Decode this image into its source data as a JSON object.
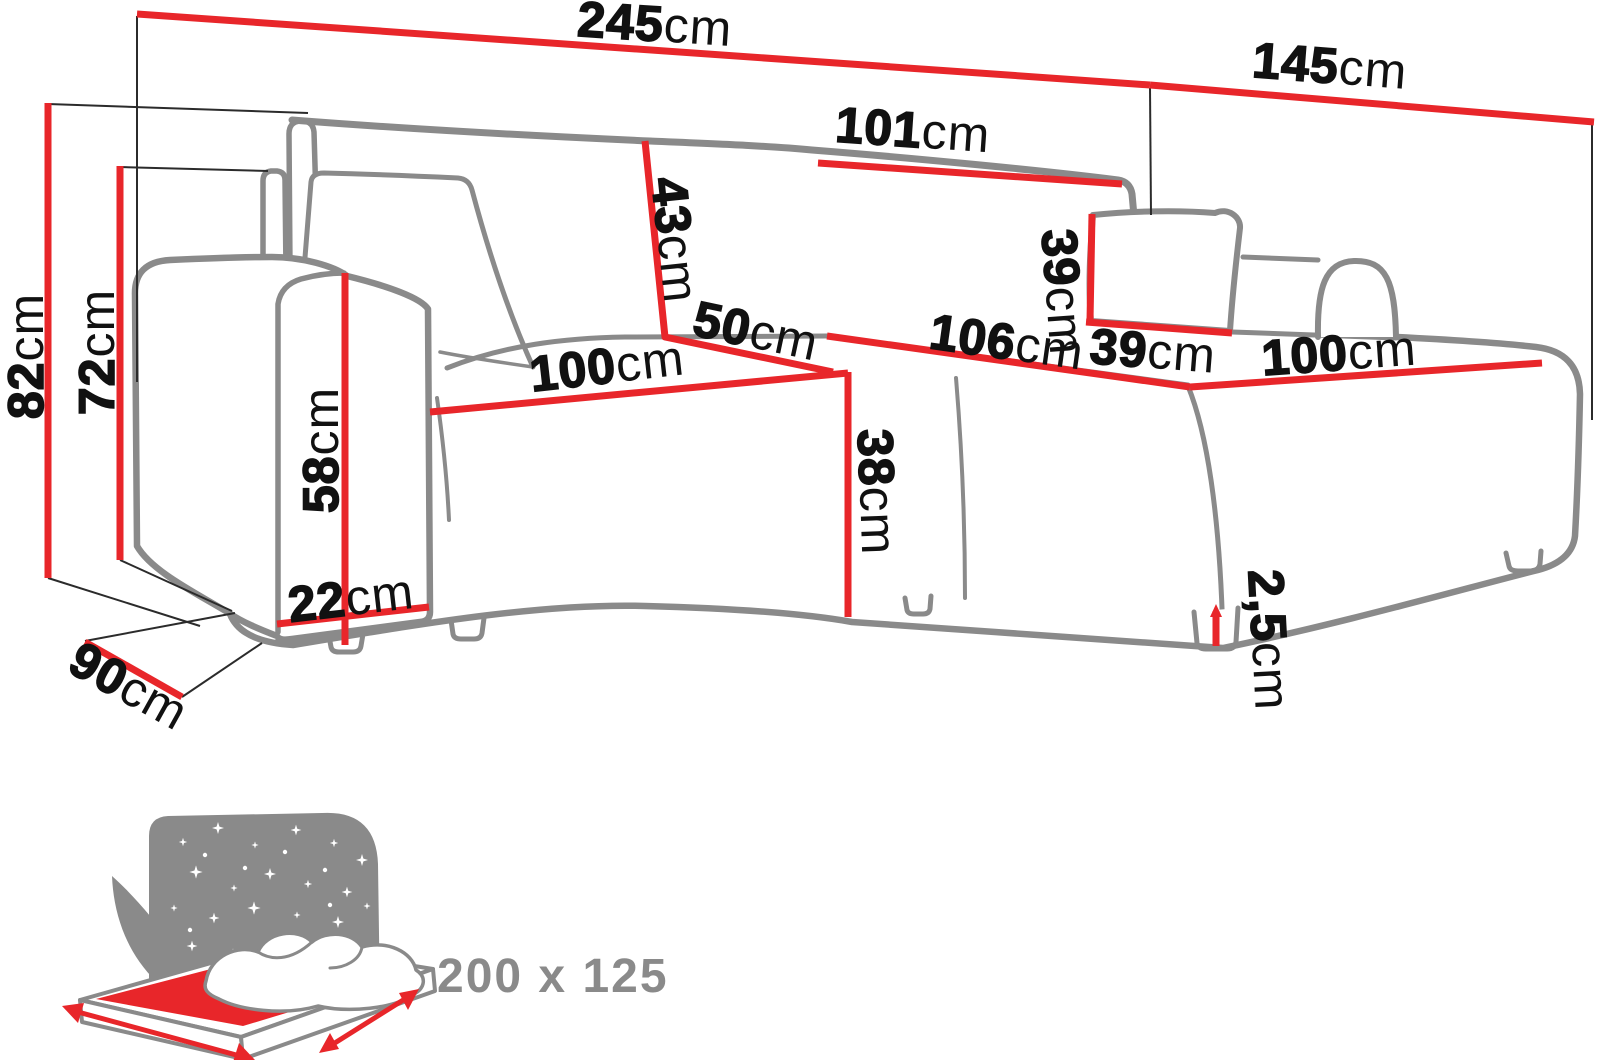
{
  "diagram": {
    "kind": "corner-sofa dimension drawing",
    "unit": "cm",
    "colors": {
      "dimension_line": "#e8262a",
      "sofa_outline": "#8a8a8a",
      "label_text": "#111111",
      "icon_gray": "#8a8a8a"
    }
  },
  "dimensions": {
    "d245": {
      "num": "245",
      "unit": "cm"
    },
    "d145": {
      "num": "145",
      "unit": "cm"
    },
    "d101": {
      "num": "101",
      "unit": "cm"
    },
    "d43": {
      "num": "43",
      "unit": "cm"
    },
    "d50": {
      "num": "50",
      "unit": "cm"
    },
    "d100l": {
      "num": "100",
      "unit": "cm"
    },
    "d38": {
      "num": "38",
      "unit": "cm"
    },
    "d106": {
      "num": "106",
      "unit": "cm"
    },
    "d100r": {
      "num": "100",
      "unit": "cm"
    },
    "d39v": {
      "num": "39",
      "unit": "cm"
    },
    "d39h": {
      "num": "39",
      "unit": "cm"
    },
    "d82": {
      "num": "82",
      "unit": "cm"
    },
    "d72": {
      "num": "72",
      "unit": "cm"
    },
    "d58": {
      "num": "58",
      "unit": "cm"
    },
    "d22": {
      "num": "22",
      "unit": "cm"
    },
    "d90": {
      "num": "90",
      "unit": "cm"
    },
    "d25": {
      "num": "2,5",
      "unit": "cm"
    }
  },
  "sleep_icon": {
    "label": "200 x 125"
  }
}
